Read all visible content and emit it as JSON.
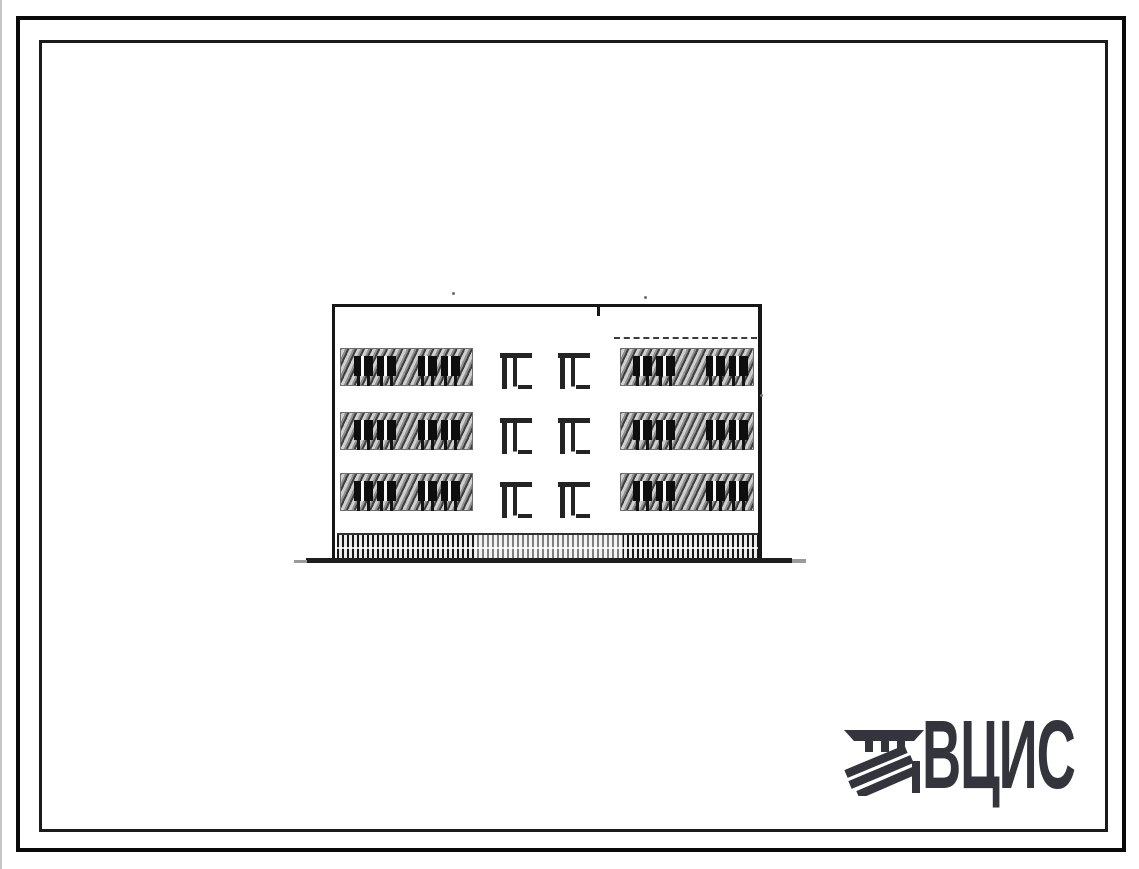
{
  "sheet": {
    "kind": "scanned architectural drawing sheet",
    "paper_color": "#ffffff",
    "frame_border_color": "#0a0a0a",
    "ink_color": "#1a1a1a"
  },
  "drawing": {
    "subject": "three-storey building facade elevation",
    "floors": 3,
    "balcony_window_bands": 6,
    "stairwell_windows": 6,
    "has_dashed_parapet_line": true,
    "has_hatched_plinth": true,
    "has_ground_line": true
  },
  "logo": {
    "text": "ВЦИС",
    "color": "#34343c",
    "emblem": "hatched-monogram-icon"
  }
}
